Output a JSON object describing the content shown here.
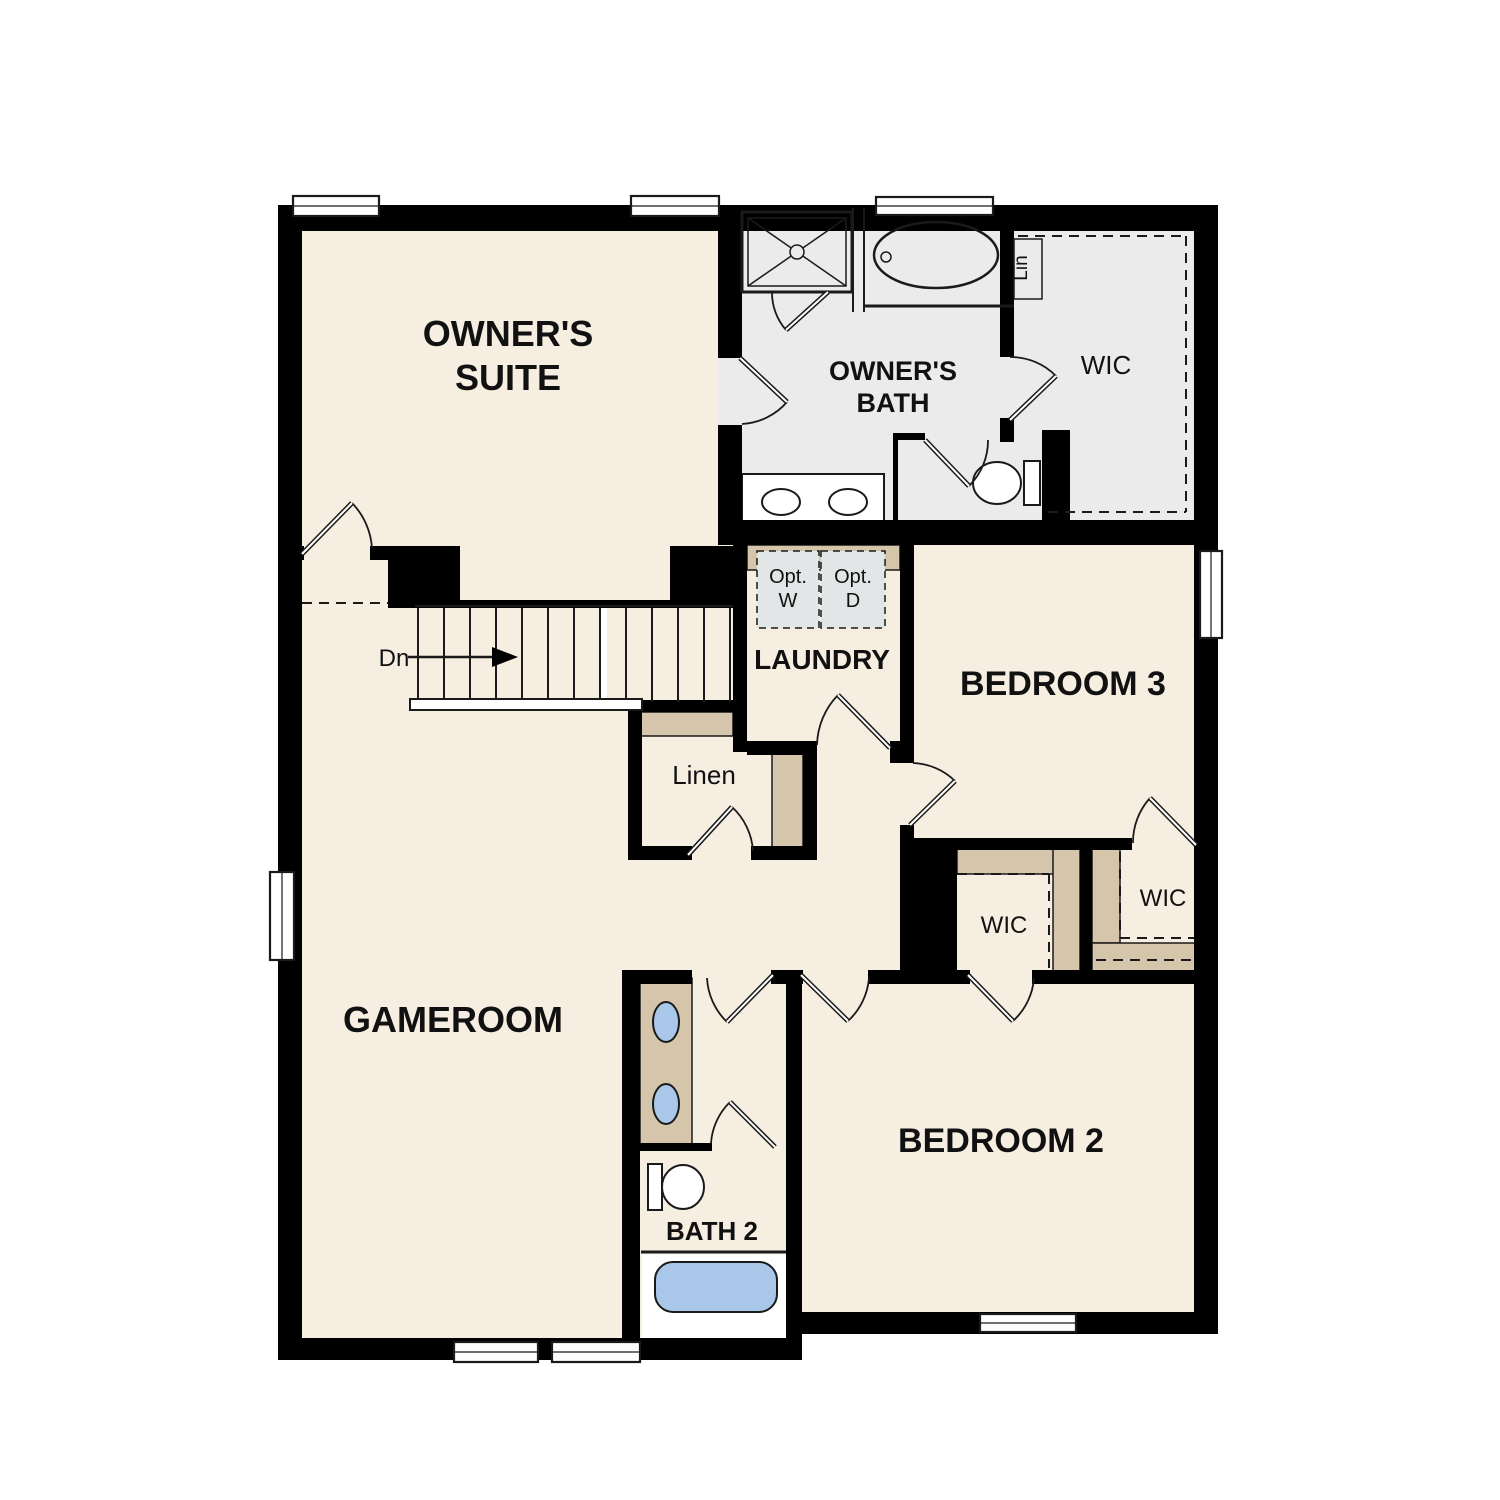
{
  "colors": {
    "k": "#000000",
    "line": "#1a1a1a",
    "cream": "#f6eee1",
    "gray": "#ebebeb",
    "tan": "#d5c6ab",
    "blue": "#a9c8e9",
    "white": "#ffffff",
    "optgray": "#e2e6e6"
  },
  "plan": {
    "width": 1500,
    "height": 1500,
    "fills": [
      {
        "x": 278,
        "y": 205,
        "w": 940,
        "h": 1107,
        "c": "cream",
        "n": "floor-main"
      },
      {
        "x": 278,
        "y": 1312,
        "w": 524,
        "h": 48,
        "c": "cream",
        "n": "floor-gameroom-south"
      },
      {
        "x": 718,
        "y": 205,
        "w": 500,
        "h": 340,
        "c": "gray",
        "n": "floor-owners-bath-and-wic"
      },
      {
        "x": 742,
        "y": 474,
        "w": 142,
        "h": 57,
        "c": "white",
        "s": 2,
        "n": "owners-vanity-counter"
      },
      {
        "x": 642,
        "y": 1254,
        "w": 144,
        "h": 84,
        "c": "white",
        "n": "bath2-tub-room"
      }
    ],
    "cabinetry": [
      {
        "x": 747,
        "y": 545,
        "w": 153,
        "h": 25,
        "n": "laundry-counter"
      },
      {
        "x": 634,
        "y": 712,
        "w": 99,
        "h": 24,
        "n": "linen-shelf"
      },
      {
        "x": 772,
        "y": 750,
        "w": 31,
        "h": 98,
        "n": "linen-side-shelf"
      },
      {
        "x": 957,
        "y": 848,
        "w": 123,
        "h": 26,
        "n": "wic2-shelf-top"
      },
      {
        "x": 1053,
        "y": 848,
        "w": 27,
        "h": 124,
        "n": "wic2-shelf-right"
      },
      {
        "x": 1092,
        "y": 848,
        "w": 28,
        "h": 95,
        "n": "wic3-shelf-left"
      },
      {
        "x": 1092,
        "y": 943,
        "w": 104,
        "h": 29,
        "n": "wic3-shelf-bottom"
      },
      {
        "x": 640,
        "y": 978,
        "w": 52,
        "h": 167,
        "n": "bath2-vanity"
      }
    ],
    "walls": [
      [
        278,
        205,
        940,
        26
      ],
      [
        278,
        205,
        24,
        1155
      ],
      [
        278,
        1338,
        524,
        22
      ],
      [
        786,
        970,
        16,
        390
      ],
      [
        786,
        1312,
        432,
        22
      ],
      [
        1194,
        205,
        24,
        1129
      ],
      [
        718,
        231,
        24,
        127
      ],
      [
        718,
        425,
        24,
        95
      ],
      [
        718,
        520,
        500,
        25
      ],
      [
        278,
        546,
        26,
        14
      ],
      [
        370,
        546,
        20,
        14
      ],
      [
        388,
        546,
        72,
        62
      ],
      [
        670,
        546,
        64,
        62
      ],
      [
        458,
        600,
        216,
        8
      ],
      [
        733,
        545,
        14,
        207
      ],
      [
        747,
        741,
        70,
        14
      ],
      [
        890,
        741,
        24,
        22
      ],
      [
        900,
        545,
        14,
        218
      ],
      [
        900,
        825,
        14,
        25
      ],
      [
        900,
        848,
        57,
        124
      ],
      [
        912,
        838,
        220,
        12
      ],
      [
        1080,
        848,
        12,
        124
      ],
      [
        628,
        700,
        119,
        12
      ],
      [
        628,
        700,
        14,
        160
      ],
      [
        628,
        846,
        64,
        14
      ],
      [
        751,
        846,
        66,
        14
      ],
      [
        803,
        750,
        14,
        110
      ],
      [
        622,
        970,
        18,
        390
      ],
      [
        640,
        970,
        52,
        14
      ],
      [
        771,
        970,
        32,
        14
      ],
      [
        868,
        970,
        102,
        14
      ],
      [
        1032,
        970,
        164,
        14
      ],
      [
        1000,
        231,
        14,
        126
      ],
      [
        1000,
        418,
        14,
        24
      ],
      [
        1042,
        430,
        28,
        100
      ],
      [
        893,
        433,
        5,
        97
      ],
      [
        893,
        433,
        32,
        7
      ],
      [
        640,
        1143,
        72,
        8
      ]
    ],
    "fixtures": [
      {
        "t": "r",
        "x": 742,
        "y": 212,
        "w": 110,
        "h": 80,
        "s": 3,
        "n": "shower"
      },
      {
        "t": "r",
        "x": 748,
        "y": 218,
        "w": 98,
        "h": 68,
        "s": 1.5,
        "n": "shower-pan"
      },
      {
        "t": "l",
        "x1": 748,
        "y1": 218,
        "x2": 846,
        "y2": 286,
        "s": 1.5,
        "n": "shower-x"
      },
      {
        "t": "l",
        "x1": 846,
        "y1": 218,
        "x2": 748,
        "y2": 286,
        "s": 1.5,
        "n": "shower-x"
      },
      {
        "t": "c",
        "cx": 797,
        "cy": 252,
        "r": 7,
        "c": "gray",
        "s": 1.5,
        "n": "shower-drain"
      },
      {
        "t": "l",
        "x1": 853,
        "y1": 208,
        "x2": 853,
        "y2": 312,
        "s": 2,
        "n": "tub-wall"
      },
      {
        "t": "l",
        "x1": 864,
        "y1": 208,
        "x2": 864,
        "y2": 312,
        "s": 2,
        "n": "tub-wall"
      },
      {
        "t": "l",
        "x1": 864,
        "y1": 306,
        "x2": 1014,
        "y2": 306,
        "s": 3,
        "n": "tub-alcove-edge"
      },
      {
        "t": "e",
        "cx": 936,
        "cy": 255,
        "rx": 62,
        "ry": 33,
        "s": 2.5,
        "n": "owners-tub"
      },
      {
        "t": "c",
        "cx": 886,
        "cy": 257,
        "r": 5,
        "s": 1.5,
        "n": "owners-tub-faucet"
      },
      {
        "t": "e",
        "cx": 781,
        "cy": 502,
        "rx": 19,
        "ry": 13,
        "c": "white",
        "s": 2,
        "n": "owners-sink"
      },
      {
        "t": "e",
        "cx": 848,
        "cy": 502,
        "rx": 19,
        "ry": 13,
        "c": "white",
        "s": 2,
        "n": "owners-sink"
      },
      {
        "t": "r",
        "x": 1024,
        "y": 461,
        "w": 16,
        "h": 44,
        "c": "white",
        "s": 2,
        "n": "owners-toilet-tank"
      },
      {
        "t": "e",
        "cx": 997,
        "cy": 483,
        "rx": 24,
        "ry": 21,
        "c": "white",
        "s": 2,
        "n": "owners-toilet-bowl"
      },
      {
        "t": "r",
        "x": 1014,
        "y": 239,
        "w": 28,
        "h": 60,
        "c": "gray",
        "s": 1.5,
        "n": "lin-closet"
      },
      {
        "t": "r",
        "x": 757,
        "y": 551,
        "w": 62,
        "h": 77,
        "c": "optgray",
        "s": 1.5,
        "da": "7 5",
        "n": "opt-washer-box"
      },
      {
        "t": "r",
        "x": 821,
        "y": 551,
        "w": 64,
        "h": 77,
        "c": "optgray",
        "s": 1.5,
        "da": "7 5",
        "n": "opt-dryer-box"
      },
      {
        "t": "l",
        "x1": 415,
        "y1": 606,
        "x2": 733,
        "y2": 606,
        "s": 2.5,
        "n": "stair-top-edge"
      },
      {
        "t": "e",
        "cx": 666,
        "cy": 1022,
        "rx": 13,
        "ry": 20,
        "c": "blue",
        "s": 2,
        "n": "bath2-sink"
      },
      {
        "t": "e",
        "cx": 666,
        "cy": 1104,
        "rx": 13,
        "ry": 20,
        "c": "blue",
        "s": 2,
        "n": "bath2-sink"
      },
      {
        "t": "r",
        "x": 648,
        "y": 1164,
        "w": 14,
        "h": 46,
        "c": "white",
        "s": 2,
        "n": "bath2-toilet-tank"
      },
      {
        "t": "e",
        "cx": 683,
        "cy": 1187,
        "rx": 21,
        "ry": 22,
        "c": "white",
        "s": 2,
        "n": "bath2-toilet-bowl"
      },
      {
        "t": "l",
        "x1": 641,
        "y1": 1252,
        "x2": 786,
        "y2": 1252,
        "s": 3,
        "n": "bath2-tub-wall"
      },
      {
        "t": "r",
        "x": 655,
        "y": 1262,
        "w": 122,
        "h": 50,
        "rx": 18,
        "c": "blue",
        "s": 2,
        "n": "bath2-tub"
      },
      {
        "t": "l",
        "x1": 408,
        "y1": 657,
        "x2": 496,
        "y2": 657,
        "s": 2.5,
        "n": "down-arrow-shaft"
      },
      {
        "t": "p",
        "pts": "492,647 492,667 518,657",
        "c": "k",
        "n": "down-arrow-head"
      }
    ],
    "dashed": [
      [
        302,
        603,
        388,
        603
      ],
      [
        1018,
        236,
        1186,
        236
      ],
      [
        1186,
        236,
        1186,
        512
      ],
      [
        1048,
        512,
        1186,
        512
      ],
      [
        957,
        874,
        1049,
        874
      ],
      [
        1049,
        874,
        1049,
        968
      ],
      [
        1120,
        852,
        1120,
        938
      ],
      [
        1120,
        938,
        1194,
        938
      ],
      [
        1096,
        960,
        1194,
        960
      ]
    ],
    "stairs": {
      "x0": 418,
      "step": 26,
      "n": 13,
      "y1": 608,
      "y2": 702,
      "brk": {
        "x": 601,
        "y": 608,
        "w": 6,
        "h": 94
      },
      "stringer": {
        "x": 410,
        "y": 699,
        "w": 232,
        "h": 11
      }
    },
    "windows": [
      {
        "x": 293,
        "y": 196,
        "w": 86,
        "h": 20,
        "o": "h"
      },
      {
        "x": 631,
        "y": 196,
        "w": 88,
        "h": 20,
        "o": "h"
      },
      {
        "x": 876,
        "y": 197,
        "w": 117,
        "h": 18,
        "o": "h"
      },
      {
        "x": 270,
        "y": 872,
        "w": 24,
        "h": 88,
        "o": "v"
      },
      {
        "x": 1200,
        "y": 551,
        "w": 22,
        "h": 87,
        "o": "v"
      },
      {
        "x": 454,
        "y": 1342,
        "w": 84,
        "h": 20,
        "o": "h"
      },
      {
        "x": 552,
        "y": 1342,
        "w": 88,
        "h": 20,
        "o": "h"
      },
      {
        "x": 980,
        "y": 1314,
        "w": 96,
        "h": 18,
        "o": "h"
      }
    ],
    "doors": [
      {
        "h": [
          302,
          554
        ],
        "t": [
          352,
          503
        ],
        "s": [
          372,
          548
        ],
        "f": 1,
        "n": "door-owners-suite"
      },
      {
        "h": [
          740,
          358
        ],
        "t": [
          787,
          402
        ],
        "s": [
          742,
          424
        ],
        "f": 1,
        "n": "door-owners-bath"
      },
      {
        "h": [
          1010,
          420
        ],
        "t": [
          1056,
          376
        ],
        "s": [
          1010,
          357
        ],
        "f": 0,
        "n": "door-owners-wic"
      },
      {
        "h": [
          925,
          440
        ],
        "t": [
          969,
          486
        ],
        "s": [
          988,
          440
        ],
        "f": 0,
        "n": "door-toilet-room"
      },
      {
        "h": [
          828,
          292
        ],
        "t": [
          786,
          330
        ],
        "s": [
          772,
          292
        ],
        "f": 1,
        "n": "door-shower"
      },
      {
        "h": [
          890,
          748
        ],
        "t": [
          838,
          695
        ],
        "s": [
          817,
          745
        ],
        "f": 0,
        "n": "door-laundry"
      },
      {
        "h": [
          910,
          825
        ],
        "t": [
          955,
          781
        ],
        "s": [
          913,
          763
        ],
        "f": 0,
        "n": "door-bedroom3"
      },
      {
        "h": [
          1196,
          845
        ],
        "t": [
          1150,
          798
        ],
        "s": [
          1133,
          843
        ],
        "f": 0,
        "n": "door-bedroom3-wic"
      },
      {
        "h": [
          688,
          855
        ],
        "t": [
          732,
          807
        ],
        "s": [
          753,
          851
        ],
        "f": 1,
        "n": "door-linen"
      },
      {
        "h": [
          773,
          975
        ],
        "t": [
          727,
          1022
        ],
        "s": [
          707,
          978
        ],
        "f": 1,
        "n": "door-bath2"
      },
      {
        "h": [
          801,
          975
        ],
        "t": [
          848,
          1021
        ],
        "s": [
          869,
          978
        ],
        "f": 0,
        "n": "door-bedroom2"
      },
      {
        "h": [
          968,
          975
        ],
        "t": [
          1013,
          1021
        ],
        "s": [
          1034,
          978
        ],
        "f": 0,
        "n": "door-bedroom2-wic"
      },
      {
        "h": [
          775,
          1147
        ],
        "t": [
          730,
          1102
        ],
        "s": [
          711,
          1143
        ],
        "f": 0,
        "n": "door-bath2-inner"
      }
    ],
    "labels": [
      {
        "t": "OWNER'S",
        "x": 508,
        "y": 346,
        "fs": 36,
        "b": 1,
        "n": "label-owners-suite-1"
      },
      {
        "t": "SUITE",
        "x": 508,
        "y": 390,
        "fs": 36,
        "b": 1,
        "n": "label-owners-suite-2"
      },
      {
        "t": "OWNER'S",
        "x": 893,
        "y": 380,
        "fs": 27,
        "b": 1,
        "n": "label-owners-bath-1"
      },
      {
        "t": "BATH",
        "x": 893,
        "y": 412,
        "fs": 27,
        "b": 1,
        "n": "label-owners-bath-2"
      },
      {
        "t": "WIC",
        "x": 1106,
        "y": 374,
        "fs": 26,
        "n": "label-owners-wic"
      },
      {
        "t": "Lin",
        "x": 1027,
        "y": 268,
        "fs": 19,
        "r": -90,
        "n": "label-lin"
      },
      {
        "t": "Opt.",
        "x": 788,
        "y": 583,
        "fs": 20,
        "n": "label-opt-w-1"
      },
      {
        "t": "W",
        "x": 788,
        "y": 607,
        "fs": 20,
        "n": "label-opt-w-2"
      },
      {
        "t": "Opt.",
        "x": 853,
        "y": 583,
        "fs": 20,
        "n": "label-opt-d-1"
      },
      {
        "t": "D",
        "x": 853,
        "y": 607,
        "fs": 20,
        "n": "label-opt-d-2"
      },
      {
        "t": "LAUNDRY",
        "x": 822,
        "y": 669,
        "fs": 28,
        "b": 1,
        "n": "label-laundry"
      },
      {
        "t": "BEDROOM 3",
        "x": 1063,
        "y": 695,
        "fs": 34,
        "b": 1,
        "n": "label-bedroom3"
      },
      {
        "t": "Dn",
        "x": 394,
        "y": 666,
        "fs": 24,
        "n": "label-dn"
      },
      {
        "t": "Linen",
        "x": 704,
        "y": 784,
        "fs": 26,
        "n": "label-linen"
      },
      {
        "t": "WIC",
        "x": 1004,
        "y": 933,
        "fs": 24,
        "n": "label-wic-bedroom2"
      },
      {
        "t": "WIC",
        "x": 1163,
        "y": 906,
        "fs": 24,
        "n": "label-wic-bedroom3"
      },
      {
        "t": "GAMEROOM",
        "x": 453,
        "y": 1032,
        "fs": 36,
        "b": 1,
        "n": "label-gameroom"
      },
      {
        "t": "BATH 2",
        "x": 712,
        "y": 1240,
        "fs": 26,
        "b": 1,
        "n": "label-bath2"
      },
      {
        "t": "BEDROOM 2",
        "x": 1001,
        "y": 1152,
        "fs": 34,
        "b": 1,
        "n": "label-bedroom2"
      }
    ]
  }
}
